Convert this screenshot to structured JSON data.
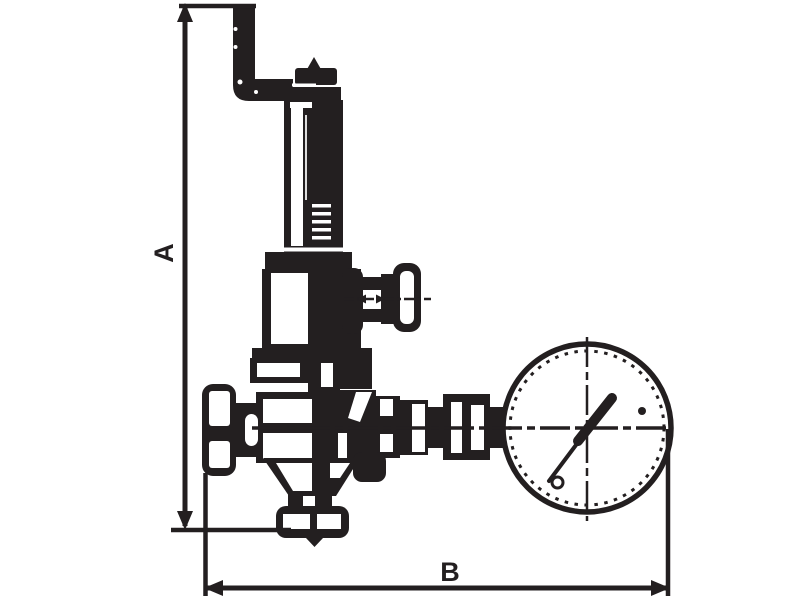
{
  "diagram": {
    "subject": "pressure-reducing-valve-with-pressure-gauge-technical-drawing",
    "background_color": "#ffffff",
    "ink_color": "#231f20",
    "dimension_a": {
      "label": "A"
    },
    "dimension_b": {
      "label": "B"
    }
  }
}
